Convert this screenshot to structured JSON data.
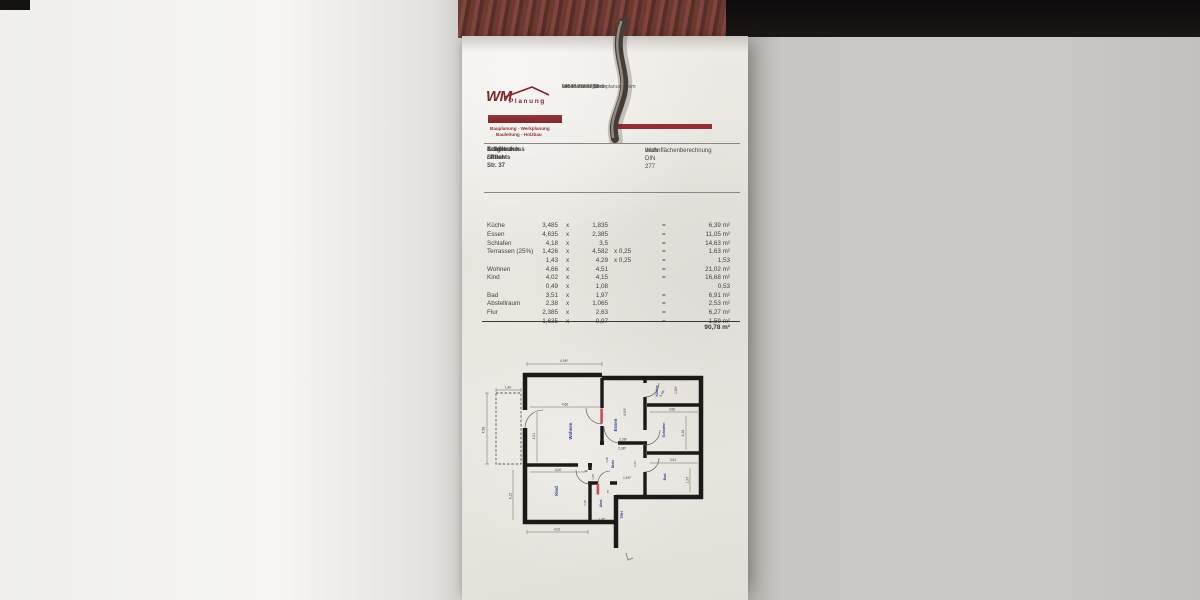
{
  "letterhead": {
    "logo_wm": "WM",
    "logo_planung": "Planung",
    "tagline1": "Bauplanung - Werkplanung",
    "tagline2": "Bauleitung - Holzbau",
    "address_line1": "Lehenstraße 33",
    "address_line2": "94538 Fürstenstein",
    "phone": "08546/ 97 47 36 3",
    "email": "wm-manfred@wm-planung.com",
    "brand_color": "#8e3036"
  },
  "project": {
    "street": "Adalbert-Stifter-Str. 37",
    "city": "Schöllnach",
    "unit": "Erdgeschoss / Rechts",
    "doc_title_line1": "Wohnflächenberechnung",
    "doc_title_line2": "nach DIN 277"
  },
  "table": {
    "rows": [
      {
        "name": "Küche",
        "a": "3,485",
        "x": "x",
        "b": "1,835",
        "f": "",
        "eq": "=",
        "area": "6,39 m²"
      },
      {
        "name": "Essen",
        "a": "4,635",
        "x": "x",
        "b": "2,385",
        "f": "",
        "eq": "=",
        "area": "11,05 m²"
      },
      {
        "name": "Schlafen",
        "a": "4,18",
        "x": "x",
        "b": "3,5",
        "f": "",
        "eq": "=",
        "area": "14,63 m²"
      },
      {
        "name": "Terrassen (25%)",
        "a": "1,426",
        "x": "x",
        "b": "4,582",
        "f": "x  0,25",
        "eq": "=",
        "area": "1,63 m²"
      },
      {
        "name": "",
        "a": "1,43",
        "x": "x",
        "b": "4,29",
        "f": "x  0,25",
        "eq": "=",
        "area": "1,53"
      },
      {
        "name": "Wohnen",
        "a": "4,66",
        "x": "x",
        "b": "4,51",
        "f": "",
        "eq": "=",
        "area": "21,02 m²"
      },
      {
        "name": "Kind",
        "a": "4,02",
        "x": "x",
        "b": "4,15",
        "f": "",
        "eq": "=",
        "area": "16,68 m²"
      },
      {
        "name": "",
        "a": "0,49",
        "x": "x",
        "b": "1,08",
        "f": "",
        "eq": "",
        "area": "0,53"
      },
      {
        "name": "Bad",
        "a": "3,51",
        "x": "x",
        "b": "1,97",
        "f": "",
        "eq": "=",
        "area": "6,91 m²"
      },
      {
        "name": "Abstellraum",
        "a": "2,38",
        "x": "x",
        "b": "1,065",
        "f": "",
        "eq": "=",
        "area": "2,53 m²"
      },
      {
        "name": "Flur",
        "a": "2,385",
        "x": "x",
        "b": "2,63",
        "f": "",
        "eq": "=",
        "area": "6,27 m²"
      },
      {
        "name": "",
        "a": "1,635",
        "x": "x",
        "b": "0,97",
        "f": "",
        "eq": "=",
        "area": "1,59 m²"
      }
    ],
    "total": "90,78 m²"
  },
  "plan": {
    "label_color": "#2b3a96",
    "rooms": {
      "wohnen": "Wohnen",
      "essen": "Essen",
      "kueche": "Küche",
      "schlafen": "Schlafen",
      "kind": "Kind",
      "diele": "Diele",
      "bad": "Bad",
      "abst": "Abst.",
      "trh": "TRH"
    },
    "dims": {
      "top": "4,98⁵",
      "terr_w": "1,40",
      "terr_h": "4,58",
      "wohnen_w": "4,66",
      "wohnen_h": "4,51",
      "essen_h": "4,63⁵",
      "essen_w": "2,38⁵",
      "diele_w_top": "2,38⁵",
      "kueche_w": "3,48⁵",
      "kueche_h": "1,83⁵",
      "schlafen_w": "3,50",
      "schlafen_h": "4,18",
      "kind_w_top": "4,00",
      "kind_w": "4,02",
      "kind_h": "4,15",
      "notch_w": ",49",
      "notch_h": "1,08",
      "bad_w": "3,51",
      "bad_h": "1,97",
      "diele_h": "1,08",
      "diele_w": "2,63",
      "diele_b": "1,63⁵",
      "abst_h": "2,38",
      "abst_w": "1,06⁵",
      "abst_d": ",75"
    }
  }
}
